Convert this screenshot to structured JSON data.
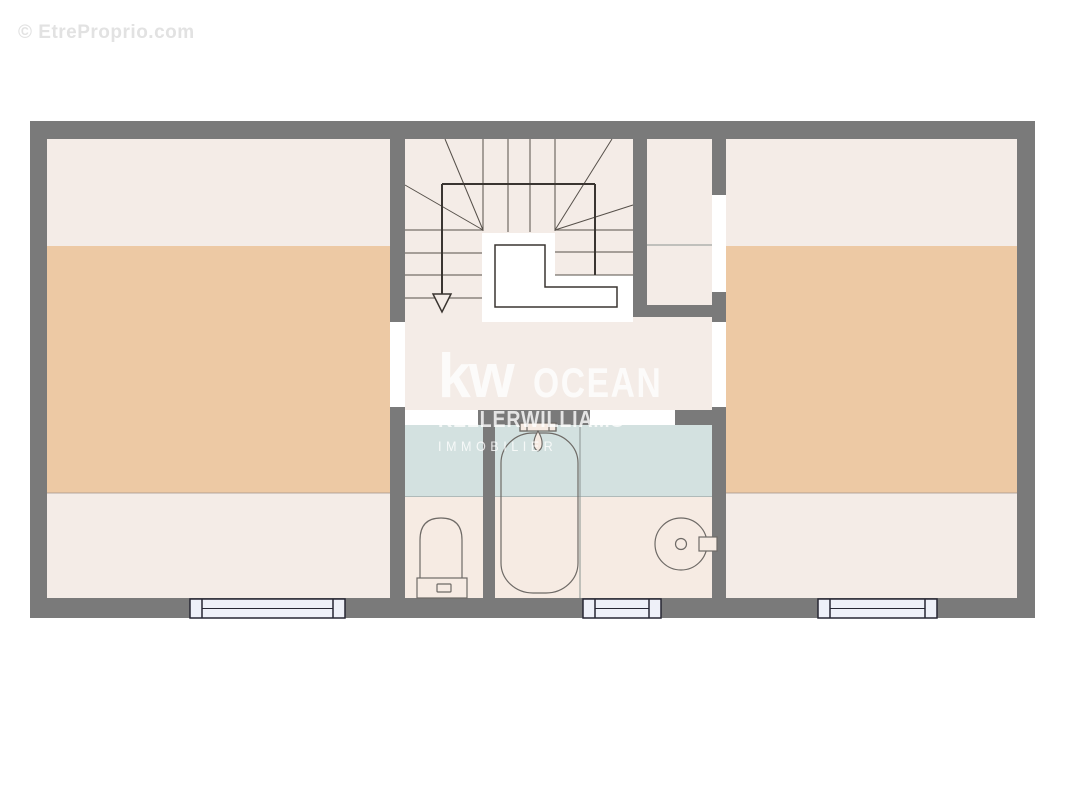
{
  "watermarks": {
    "corner": "© EtreProprio.com",
    "agency_logo": "kw",
    "agency_name": "OCEAN",
    "agency_brand": "KELLERWILLIAMS",
    "agency_tagline": "IMMOBILIER"
  },
  "colors": {
    "page_bg": "#ffffff",
    "wall": "#7a7a7a",
    "room_light": "#f4ece7",
    "peach": "#edc9a4",
    "bath_blue": "#d3e1e0",
    "bath_pink": "#f6ebe3",
    "window_fill": "#eef0f8",
    "window_frame": "#262633",
    "stair_line": "#56504a",
    "rail": "#3a3531",
    "fixture": "#6e6a66",
    "divider": "#8b9492",
    "height_line": "#a0918a",
    "watermark_white": "#ffffff",
    "watermark_gray": "#e2e2e2"
  },
  "plan": {
    "fixtures": [
      "toilet",
      "bathtub",
      "shower-mixer",
      "washbasin"
    ],
    "features": [
      "u-shaped-staircase",
      "stairwell-void",
      "down-arrow"
    ],
    "windows_count": 3,
    "door_openings_count": 5
  }
}
